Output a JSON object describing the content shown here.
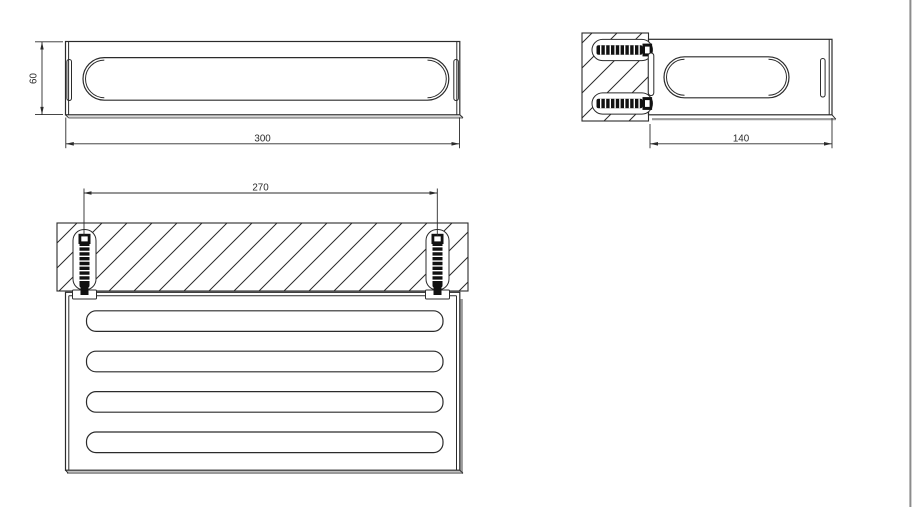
{
  "page": {
    "background": "#ffffff",
    "border_color": "#8c8c8c"
  },
  "drawing": {
    "line_color": "#2b2b2b",
    "screw_color": "#111111",
    "shadow_color": "#9a9a9a",
    "dimensions": {
      "front_height": "60",
      "front_width": "300",
      "side_depth": "140",
      "plan_mount_spacing": "270"
    }
  }
}
